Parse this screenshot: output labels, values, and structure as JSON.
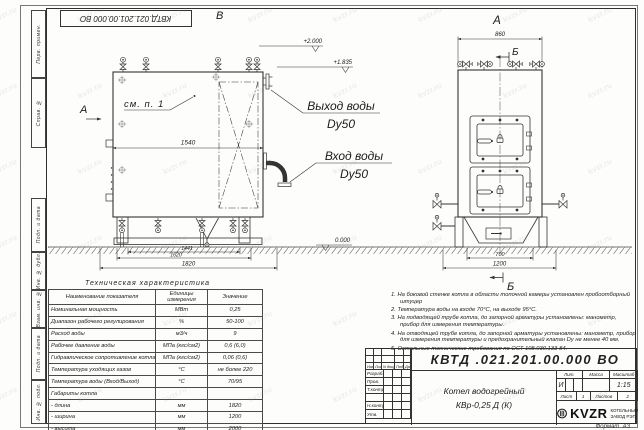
{
  "sheet": {
    "stamp_top": "КВТД.021.201.00.000 ВО",
    "watermark": "kvzr.ru",
    "format_label": "Формат",
    "format_value": "А3",
    "frame_labels": {
      "perv_primen": "Перв. примен.",
      "sprav_no": "Справ. №",
      "podp_data1": "Подп. и дата",
      "inv_dubl": "Инв. № дубл.",
      "vzam_inv": "Взам. инв. №",
      "podp_data2": "Подп. и дата",
      "inv_podl": "Инв. № подл."
    }
  },
  "front_view": {
    "view_label": "В",
    "section_label": "А",
    "callout": "см. п. 1",
    "dim_body_width": "1540",
    "dim_base_inner": "1441",
    "dim_base": "1620",
    "dim_overall": "1820",
    "elev_top": "+2.000",
    "elev_nozzle": "+1.835",
    "elev_zero": "0.000",
    "outlet_line1": "Выход воды",
    "outlet_line2": "Dy50",
    "inlet_line1": "Вход воды",
    "inlet_line2": "Dy50"
  },
  "side_view": {
    "view_label": "А",
    "section_label_top": "Б",
    "section_label_bottom": "Б",
    "dim_width": "860",
    "dim_base": "700",
    "dim_overall": "1200"
  },
  "tech_table": {
    "title": "Техническая характеристика",
    "headers": [
      "Наименование показателя",
      "Единицы измерения",
      "Значение"
    ],
    "rows": [
      [
        "Номинальная мощность",
        "МВт",
        "0,25"
      ],
      [
        "Диапазон рабочего регулирования",
        "%",
        "50-100"
      ],
      [
        "Расход воды",
        "м3/ч",
        "9"
      ],
      [
        "Рабочее давление воды",
        "МПа (кгс/см2)",
        "0,6 (6,0)"
      ],
      [
        "Гидравлическое сопротивление котла",
        "МПа (кгс/см2)",
        "0,06 (0,6)"
      ],
      [
        "Температура уходящих газов",
        "°С",
        "не более 220"
      ],
      [
        "Температура воды (Вход/Выход)",
        "°С",
        "70/95"
      ],
      [
        "Габариты котла",
        "",
        ""
      ],
      [
        "- длина",
        "мм",
        "1820"
      ],
      [
        "- ширина",
        "мм",
        "1200"
      ],
      [
        "- высота",
        "мм",
        "2000"
      ]
    ]
  },
  "notes": [
    "1. На боковой стенке котла в области топочной камеры установлен пробоотборный штуцер",
    "2. Температура воды на входе 70°С, на выходе 95°С.",
    "3. На подводящей трубе котла, до запорной арматуры установлены: манометр, прибор для измерения температуры.",
    "4. На отводящей трубе котла, до запорной арматуры установлены: манометр, прибор для измерения температуры и предохранительный клапан Dу не менее 40 мм.",
    "5. Остальные технические требования по ОСТ 108.030.133-84."
  ],
  "title_block": {
    "doc_number": "КВТД .021.201.00.000  ВО",
    "product_line1": "Котел водогрейный",
    "product_line2": "КВр-0,25  Д  (К)",
    "header_cols": [
      "Изм.",
      "Лист",
      "N докум.",
      "Подп.",
      "Дата"
    ],
    "sig_rows": [
      "Разраб.",
      "Пров.",
      "Т.контр.",
      "Н.контр.",
      "Утв."
    ],
    "lit_label": "Лит.",
    "mass_label": "Масса",
    "scale_label": "Масштаб",
    "lit_value": "И",
    "scale_value": "1:15",
    "sheet_label": "Лист",
    "sheet_value": "1",
    "sheets_label": "Листов",
    "sheets_value": "2",
    "logo_text": "KVZR",
    "company_line1": "КОТЕЛЬНЫЙ",
    "company_line2": "ЗАВОД РЭП"
  }
}
